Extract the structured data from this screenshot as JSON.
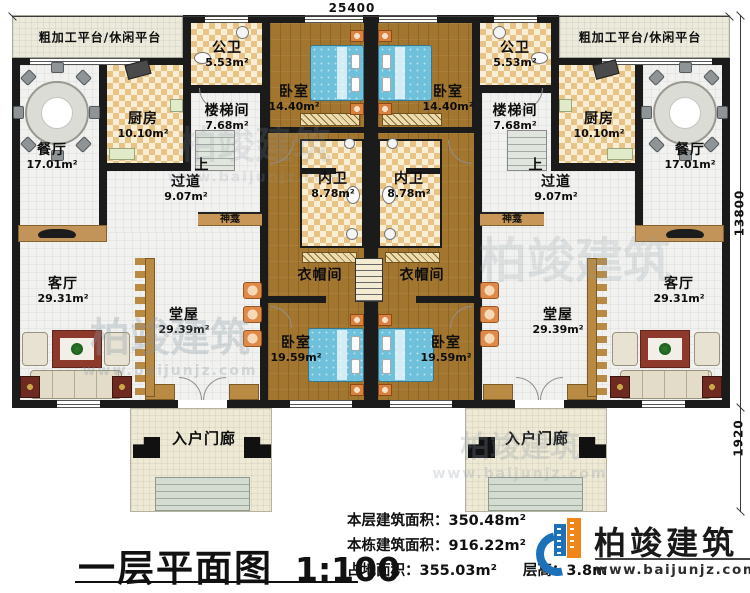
{
  "title_block": {
    "title": "一层平面图",
    "scale": "1:100"
  },
  "dimensions": {
    "width": "25400",
    "height": "13800",
    "porch_depth": "1920"
  },
  "rooms": {
    "platform": {
      "name": "粗加工平台/休闲平台"
    },
    "public_bath": {
      "name": "公卫",
      "area": "5.53m²"
    },
    "bedroom_top": {
      "name": "卧室",
      "area": "14.40m²"
    },
    "kitchen": {
      "name": "厨房",
      "area": "10.10m²"
    },
    "stairwell": {
      "name": "楼梯间",
      "area": "7.68m²"
    },
    "dining": {
      "name": "餐厅",
      "area": "17.01m²"
    },
    "corridor": {
      "name": "过道",
      "area": "9.07m²"
    },
    "stair_up": {
      "label": "上"
    },
    "inner_bath": {
      "name": "内卫",
      "area": "8.78m²"
    },
    "shrine": {
      "name": "神龛"
    },
    "cloakroom": {
      "name": "衣帽间"
    },
    "hall": {
      "name": "堂屋",
      "area": "29.39m²"
    },
    "living": {
      "name": "客厅",
      "area": "29.31m²"
    },
    "bedroom_bottom": {
      "name": "卧室",
      "area": "19.59m²"
    },
    "porch": {
      "name": "入户门廊"
    }
  },
  "stats": {
    "floor_area_label": "本层建筑面积：",
    "floor_area": "350.48m²",
    "building_area_label": "本栋建筑面积：",
    "building_area": "916.22m²",
    "footprint_label": "占地面积：",
    "footprint": "355.03m²",
    "story_height_label": "层高：",
    "story_height": "3.8m"
  },
  "logo": {
    "brand": "柏竣建筑",
    "url": "www.baijunjz.com"
  },
  "watermark": {
    "brand": "柏竣建筑",
    "url": "www.baijunjz.com"
  },
  "colors": {
    "wall": "#1b1b1b",
    "wood_floor": "#a3762f",
    "checker_tan": "#e7c386",
    "tile": "#f1f1ef",
    "bed_blue": "#6fc0db",
    "platform": "#eceadb",
    "shrine_band": "#c89758",
    "logo_blue": "#1d71b8",
    "logo_orange": "#f08519"
  }
}
